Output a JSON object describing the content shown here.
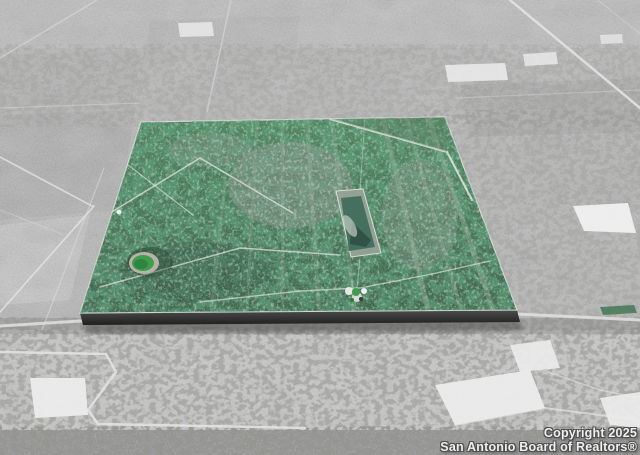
{
  "photo": {
    "type": "aerial-satellite-property-photo",
    "subject": "Color-highlighted green land parcel shown as raised tile over grayscale aerial imagery"
  },
  "watermark": {
    "line1": "Copyright 2025",
    "line2": "San Antonio Board of Realtors®"
  },
  "colors": {
    "aerial_gray": "#b6b6b6",
    "pasture_gray": "#c7c7c7",
    "parcel_green": "#3c7c50",
    "parcel_green_dark": "#2a5c3c",
    "pond_bright_green": "#3f9e4d",
    "clearing_teal": "#45705f",
    "extrusion_dark": "#2e2e2e",
    "road_white": "#e2e2e2",
    "watermark_text": "#efefef"
  }
}
